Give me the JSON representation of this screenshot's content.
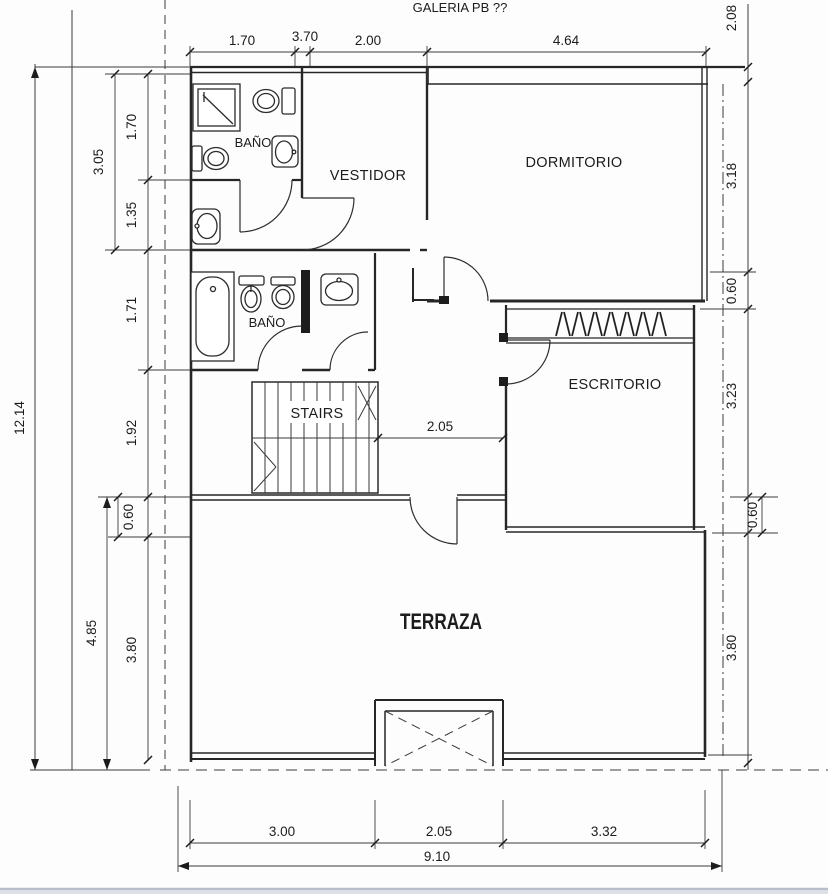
{
  "page": {
    "title": "GALERIA PB ??"
  },
  "rooms": [
    {
      "id": "bano-1",
      "label": "BAÑO"
    },
    {
      "id": "vestidor",
      "label": "VESTIDOR"
    },
    {
      "id": "dormitorio",
      "label": "DORMITORIO"
    },
    {
      "id": "bano-2",
      "label": "BAÑO"
    },
    {
      "id": "escritorio",
      "label": "ESCRITORIO"
    },
    {
      "id": "stairs",
      "label": "STAIRS"
    },
    {
      "id": "terraza",
      "label": "TERRAZA"
    }
  ],
  "dimensions": {
    "top": [
      "1.70",
      "3.70",
      "2.00",
      "4.64"
    ],
    "left_total": "12.14",
    "left_chain": [
      "3.05",
      "1.70",
      "1.35",
      "1.71",
      "1.92",
      "0.60",
      "4.85",
      "3.80"
    ],
    "right_chain": [
      "2.08",
      "3.18",
      "0.60",
      "3.23",
      "0.60",
      "3.80"
    ],
    "bottom_chain": [
      "3.00",
      "2.05",
      "3.32"
    ],
    "bottom_total": "9.10",
    "hall": "2.05"
  },
  "colors": {
    "line": "#262626",
    "background": "#fdfdfd",
    "page_edge": "#c3c9d2"
  }
}
